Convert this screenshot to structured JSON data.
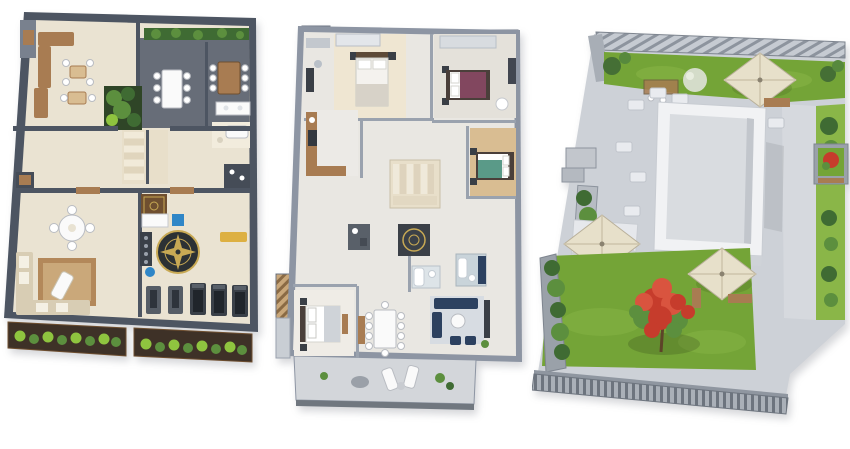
{
  "canvas": {
    "width": 850,
    "height": 449,
    "background": "#ffffff"
  },
  "plans": [
    {
      "id": "ground-floor-plan",
      "position": "left"
    },
    {
      "id": "upper-floor-plan",
      "position": "center"
    },
    {
      "id": "roof-terrace-plan",
      "position": "right"
    }
  ],
  "palette": {
    "page_bg": "#ffffff",
    "wall_dark": "#4d5562",
    "wall_mid": "#79818e",
    "wall_light": "#8d95a3",
    "floor_beige": "#eae3d2",
    "floor_cream": "#f2ecdd",
    "floor_gray": "#e9e7e2",
    "stone_dark": "#676d78",
    "wood": "#a87c52",
    "wood_dark": "#6f4f30",
    "wood_light": "#d9bd92",
    "soil": "#3e3127",
    "green_dark": "#3f6b33",
    "green_mid": "#5c8f3e",
    "green_bright": "#8fc43f",
    "lawn": "#74a437",
    "lawn_light": "#8ab648",
    "pave": "#cdd1d7",
    "pave_light": "#e9ebef",
    "white_struct": "#f1f2f4",
    "umbrella": "#e7e0ca",
    "navy": "#2c4160",
    "teal": "#5a9a88",
    "purple": "#82475f",
    "red_flower": "#c63c2c",
    "red_flower_light": "#d9543f",
    "rug": "#b3885a",
    "rug_light": "#caa87a",
    "compass": "#2c3134",
    "gold": "#c8a954",
    "blue_item": "#2f86c7",
    "yellow_item": "#ddb042",
    "treadmill": "#3a4048",
    "white_furn": "#fafafa"
  }
}
